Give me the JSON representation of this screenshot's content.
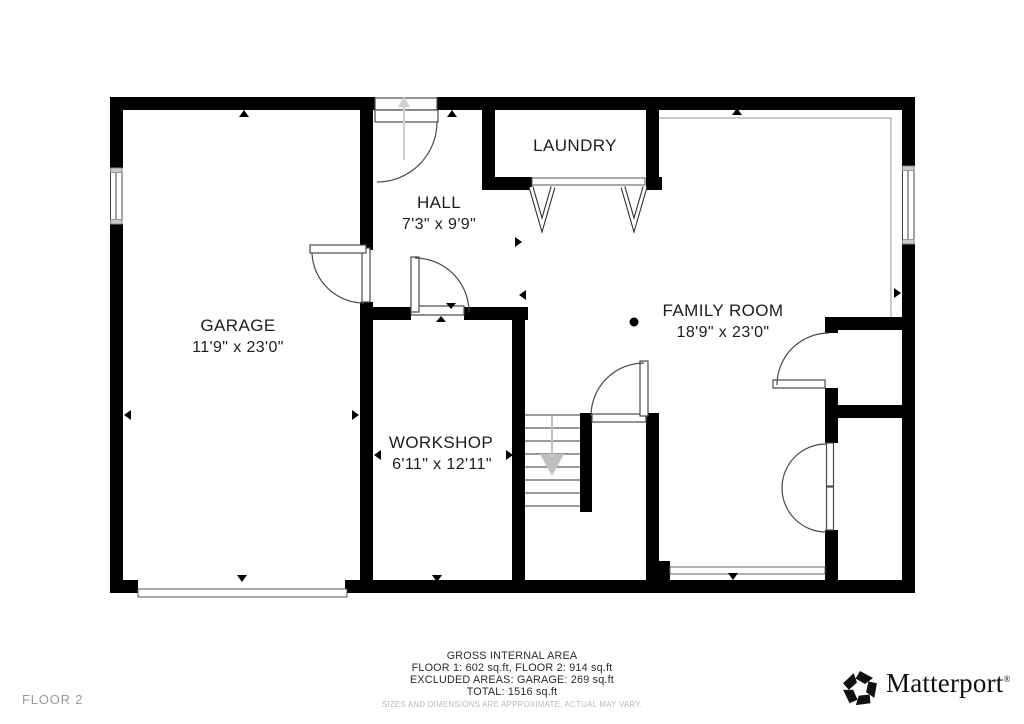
{
  "floor": {
    "label": "FLOOR 2"
  },
  "rooms": {
    "garage": {
      "name": "GARAGE",
      "dims": "11'9\" x 23'0\""
    },
    "hall": {
      "name": "HALL",
      "dims": "7'3\" x 9'9\""
    },
    "laundry": {
      "name": "LAUNDRY"
    },
    "family_room": {
      "name": "FAMILY ROOM",
      "dims": "18'9\" x 23'0\""
    },
    "workshop": {
      "name": "WORKSHOP",
      "dims": "6'11\" x 12'11\""
    }
  },
  "footer": {
    "title": "GROSS INTERNAL AREA",
    "line1": "FLOOR 1: 602 sq.ft, FLOOR 2: 914 sq.ft",
    "line2": "EXCLUDED AREAS: GARAGE: 269 sq.ft",
    "line3": "TOTAL: 1516 sq.ft",
    "disclaimer": "SIZES AND DIMENSIONS ARE APPROXIMATE, ACTUAL MAY VARY."
  },
  "branding": {
    "name": "Matterport",
    "mark": "®"
  },
  "colors": {
    "wall": "#000000",
    "door_line": "#4a4a4a",
    "ceiling_line": "#aaaaaa",
    "stair_arrow": "#c0c0c0",
    "label": "#1d1d1d",
    "muted": "#9b9b9b"
  }
}
